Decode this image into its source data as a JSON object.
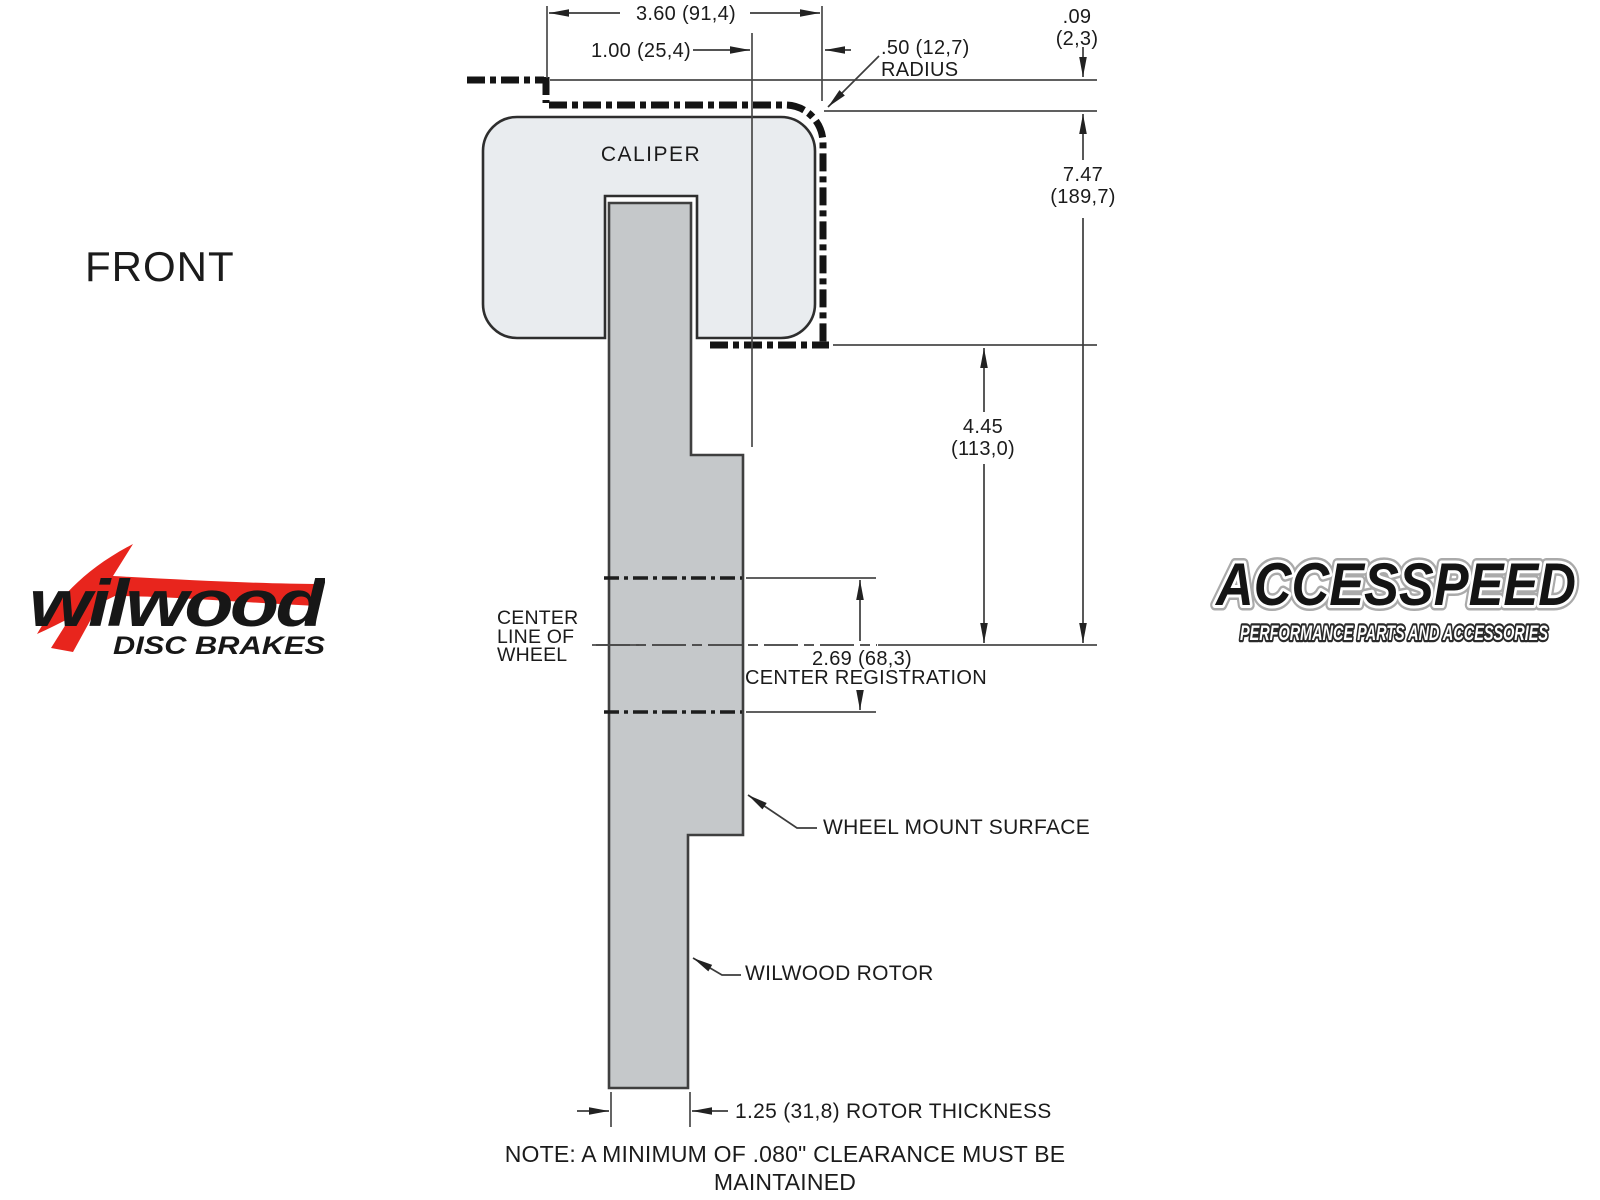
{
  "diagram": {
    "view_label": "FRONT",
    "caliper_label": "CALIPER",
    "dims": {
      "overall_width": "3.60 (91,4)",
      "offset": "1.00 (25,4)",
      "radius_line1": ".50 (12,7)",
      "radius_line2": "RADIUS",
      "clearance_line1": ".09",
      "clearance_line2": "(2,3)",
      "height_line1": "7.47",
      "height_line2": "(189,7)",
      "caliper_to_center_line1": "4.45",
      "caliper_to_center_line2": "(113,0)",
      "center_registration_value": "2.69 (68,3)",
      "center_registration_label": "CENTER REGISTRATION",
      "rotor_thickness": "1.25 (31,8) ROTOR THICKNESS"
    },
    "callouts": {
      "center_line_1": "CENTER",
      "center_line_2": "LINE OF",
      "center_line_3": "WHEEL",
      "wheel_mount": "WHEEL MOUNT SURFACE",
      "rotor": "WILWOOD ROTOR"
    },
    "note_line1": "NOTE: A MINIMUM OF .080\" CLEARANCE MUST BE MAINTAINED",
    "note_line2": "BETWEEN THE WHEEL AND CALIPER IN ALL AREAS",
    "colors": {
      "caliper_fill": "#e9ecef",
      "rotor_fill": "#c5c8ca",
      "line": "#3c3c3c",
      "phantom": "#141414",
      "wilwood_red": "#e8251d",
      "logo_black": "#161616"
    }
  },
  "logos": {
    "wilwood": {
      "name": "wilwood",
      "tagline": "DISC BRAKES"
    },
    "accesspeed": {
      "name": "ACCESSPEED",
      "tagline": "PERFORMANCE PARTS AND ACCESSORIES"
    }
  }
}
